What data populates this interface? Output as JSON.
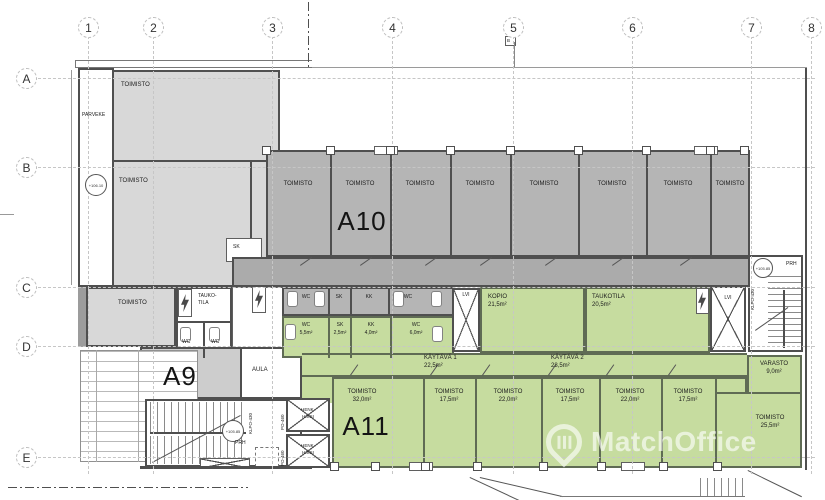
{
  "grid": {
    "columns": [
      "1",
      "2",
      "3",
      "4",
      "5",
      "6",
      "7",
      "8"
    ],
    "rows": [
      "A",
      "B",
      "C",
      "D",
      "E"
    ]
  },
  "levels": {
    "parveke": "+106.10",
    "left_stair": "+105.85",
    "right_stair": "+105.85"
  },
  "section_flag": "B",
  "left_wing": {
    "parveke": "PARVEKE",
    "office_top": "TOIMISTO",
    "office_mid": "TOIMISTO",
    "office_low": "TOIMISTO",
    "sk": "SK",
    "break_l1": "TAUKO-",
    "break_l2": "TILA",
    "wc_a": "WC",
    "wc_b": "WC",
    "a9": "A9",
    "aula": "AULA",
    "prh": "PRH",
    "stair_code": "KLPO-430",
    "lift_code_a": "PO-460",
    "lift_code_b": "PO-460",
    "lift_a_l1": "HENK.",
    "lift_a_l2": "HISSI",
    "lift_b_l1": "HENK.",
    "lift_b_l2": "HISSI"
  },
  "a10": {
    "label": "A10",
    "offices": [
      "TOIMISTO",
      "TOIMISTO",
      "TOIMISTO",
      "TOIMISTO",
      "TOIMISTO",
      "TOIMISTO",
      "TOIMISTO",
      "TOIMISTO"
    ]
  },
  "wet_gray": {
    "wc1": "WC",
    "sk": "SK",
    "kk": "KK",
    "wc2": "WC"
  },
  "wet_green": [
    {
      "name": "WC",
      "area": "5,5m²"
    },
    {
      "name": "SK",
      "area": "2,5m²"
    },
    {
      "name": "KK",
      "area": "4,0m²"
    },
    {
      "name": "WC",
      "area": "6,0m²"
    }
  ],
  "service": {
    "lvi_left": "LVI",
    "lvi_right": "LVI",
    "kopio": {
      "name": "KOPIO",
      "area": "21,5m²"
    },
    "taukotila": {
      "name": "TAUKOTILA",
      "area": "20,5m²"
    }
  },
  "corridors": [
    {
      "name": "KÄYTÄVÄ 1",
      "area": "22,5m²"
    },
    {
      "name": "KÄYTÄVÄ 2",
      "area": "28,5m²"
    }
  ],
  "a11": {
    "label": "A11",
    "offices": [
      {
        "name": "TOIMISTO",
        "area": "32,0m²"
      },
      {
        "name": "TOIMISTO",
        "area": "17,5m²"
      },
      {
        "name": "TOIMISTO",
        "area": "22,0m²"
      },
      {
        "name": "TOIMISTO",
        "area": "17,5m²"
      },
      {
        "name": "TOIMISTO",
        "area": "22,0m²"
      },
      {
        "name": "TOIMISTO",
        "area": "17,5m²"
      }
    ],
    "varasto": {
      "name": "VARASTO",
      "area": "9,0m²"
    },
    "corner_office": {
      "name": "TOIMISTO",
      "area": "25,5m²"
    }
  },
  "right_stair": {
    "prh": "PRH",
    "code": "KLPO-430"
  },
  "watermark": {
    "brand": "MatchOffice"
  },
  "colors": {
    "office_green": "#c6dc9f",
    "office_gray": "#b5b5b5",
    "room_light_gray": "#d8d8d8"
  }
}
